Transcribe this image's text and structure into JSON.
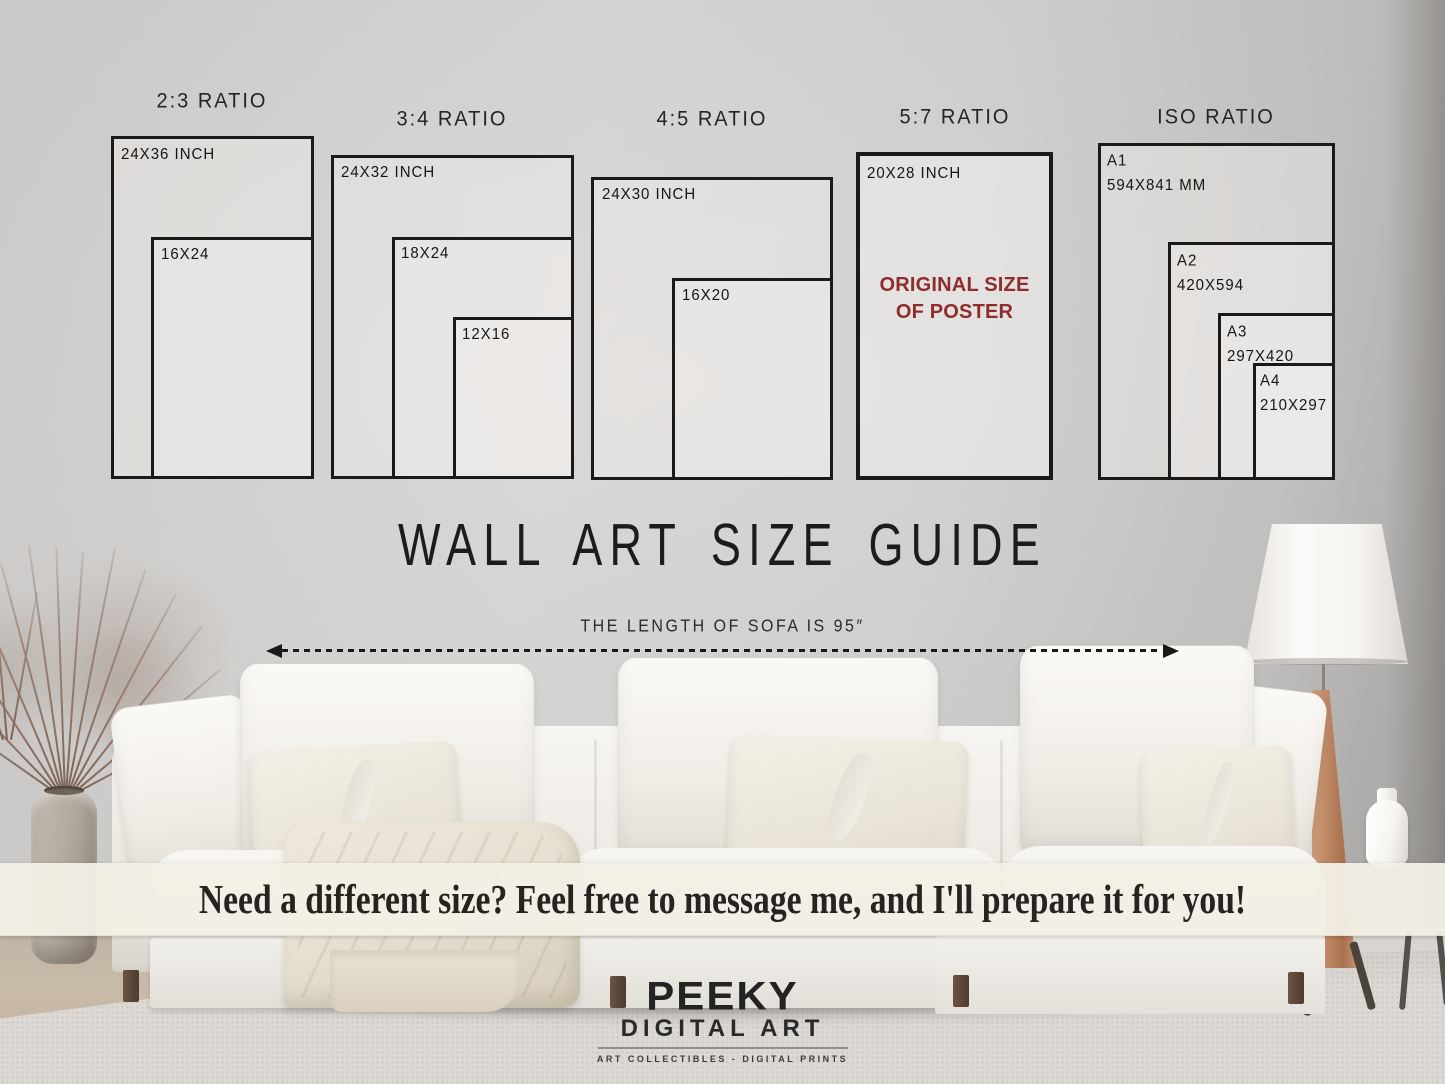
{
  "guide": {
    "heading": "WALL ART SIZE GUIDE",
    "sofa_note": "THE LENGTH OF SOFA IS 95″",
    "sections": [
      {
        "title": "2:3 RATIO",
        "boxes": [
          {
            "label": "24X36 INCH"
          },
          {
            "label": "16X24"
          }
        ]
      },
      {
        "title": "3:4 RATIO",
        "boxes": [
          {
            "label": "24X32 INCH"
          },
          {
            "label": "18X24"
          },
          {
            "label": "12X16"
          }
        ]
      },
      {
        "title": "4:5 RATIO",
        "boxes": [
          {
            "label": "24X30 INCH"
          },
          {
            "label": "16X20"
          }
        ]
      },
      {
        "title": "5:7 RATIO",
        "boxes": [
          {
            "label": "20X28 INCH"
          }
        ],
        "callout_line1": "ORIGINAL SIZE",
        "callout_line2": "OF POSTER"
      },
      {
        "title": "ISO RATIO",
        "boxes": [
          {
            "label": "A1",
            "sub": "594X841 MM"
          },
          {
            "label": "A2",
            "sub": "420X594"
          },
          {
            "label": "A3",
            "sub": "297X420"
          },
          {
            "label": "A4",
            "sub": "210X297"
          }
        ]
      }
    ]
  },
  "banner": {
    "message": "Need a different size? Feel free to message me, and I'll prepare it for you!"
  },
  "logo": {
    "name": "PEEKY",
    "line2": "DIGITAL ART",
    "tagline": "ART COLLECTIBLES - DIGITAL PRINTS"
  },
  "colors": {
    "accent_red": "#8e2c2e",
    "line_color": "#191919",
    "banner_bg": "#f2efe6"
  }
}
